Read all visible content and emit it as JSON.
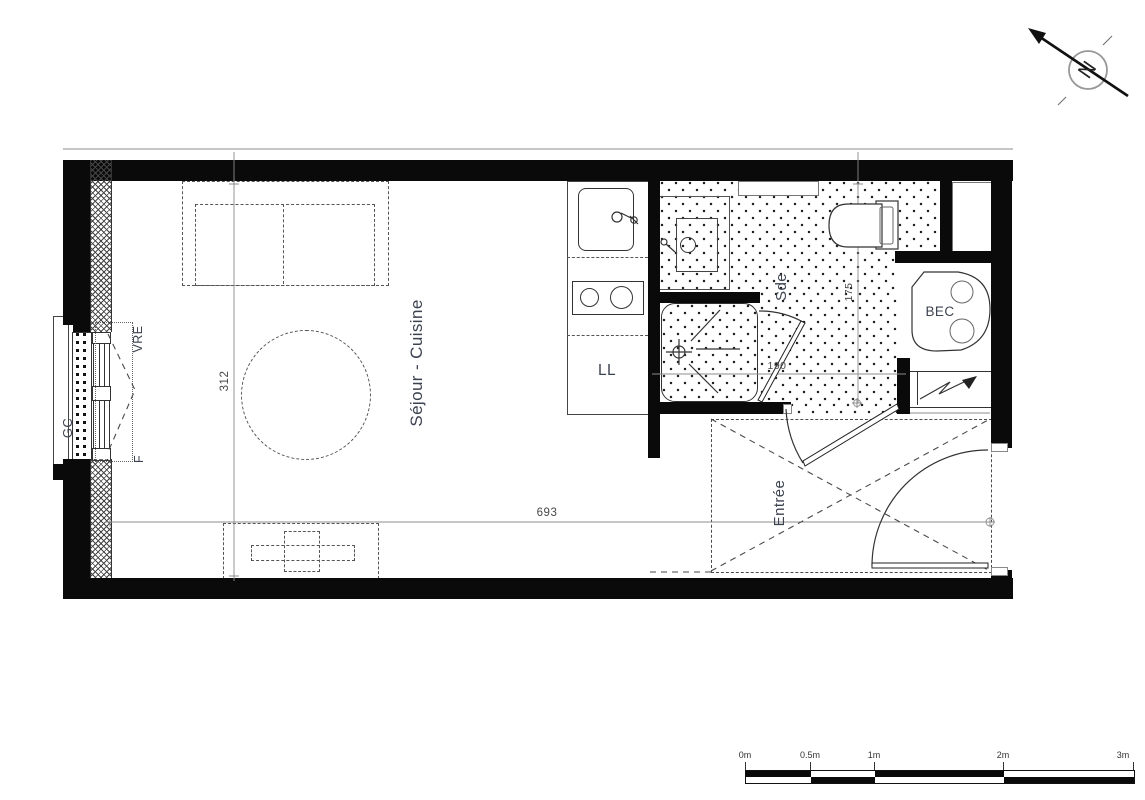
{
  "labels": {
    "sejour_cuisine": "Séjour - Cuisine",
    "entree": "Entrée",
    "sde": "Sde",
    "bec": "BEC",
    "ll": "LL",
    "gc": "GC",
    "vre": "VRE",
    "f": "F",
    "north": "N"
  },
  "dimensions": {
    "width_total": "693",
    "height_living": "312",
    "sde_height": "175",
    "sde_width": "190"
  },
  "scale_bar": {
    "labels": [
      "0m",
      "0.5m",
      "1m",
      "2m",
      "3m"
    ]
  },
  "colors": {
    "wall": "#0a0a0a",
    "line": "#333333",
    "dim": "#8c8c8c",
    "label": "#3c4350"
  }
}
